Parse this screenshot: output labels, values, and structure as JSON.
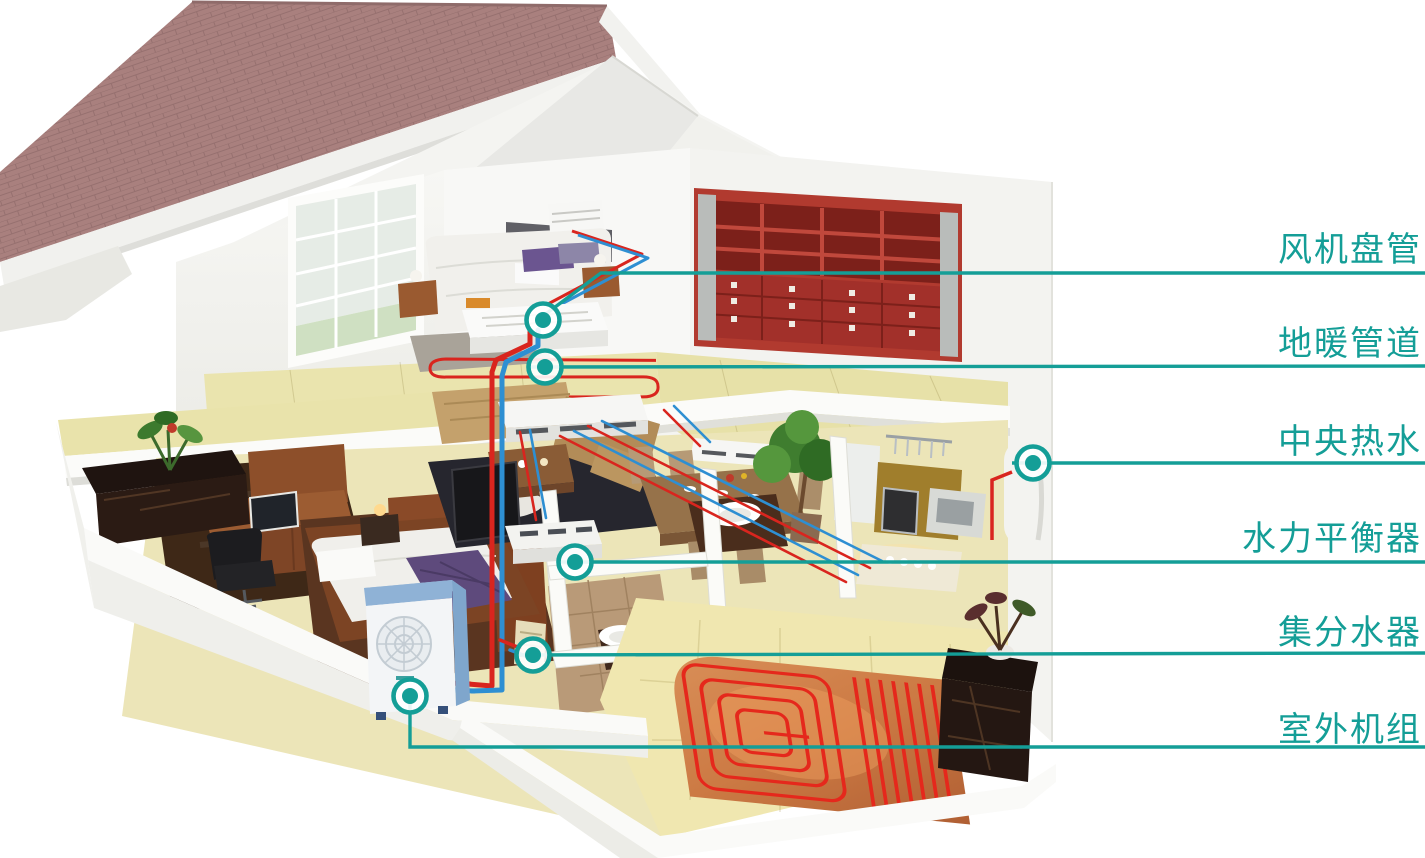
{
  "figure": {
    "type": "cutaway-house-hvac-diagram",
    "background": "#ffffff",
    "palette": {
      "accent": "#149e97",
      "pipe_red": "#d9251e",
      "pipe_blue": "#2e8fd2",
      "roof": "#a9807e",
      "roof_line": "#8f6b6a",
      "floor_yellow": "#eae4ac",
      "bookshelf_red": "#b13a2f",
      "outdoor_unit_blue": "#8fb2d6",
      "heating_pad_copper": "#c97b4b",
      "marble_dark": "#241712",
      "wood": "#8a4f2a"
    },
    "annotations": [
      {
        "id": "fan-coil",
        "text": "风机盘管",
        "label_x": 1422,
        "label_y": 261,
        "marker": [
          543,
          320
        ],
        "line": [
          [
            543,
            316
          ],
          [
            601,
            273
          ],
          [
            1425,
            273
          ]
        ]
      },
      {
        "id": "floor-heating-pipe",
        "text": "地暖管道",
        "label_x": 1422,
        "label_y": 355,
        "marker": [
          545,
          367
        ],
        "line": [
          [
            527,
            367
          ],
          [
            1425,
            366
          ]
        ]
      },
      {
        "id": "central-hot-water",
        "text": "中央热水",
        "label_x": 1422,
        "label_y": 453,
        "marker": [
          1033,
          463
        ],
        "line": [
          [
            1012,
            463
          ],
          [
            1425,
            463
          ]
        ]
      },
      {
        "id": "hydraulic-balancer",
        "text": "水力平衡器",
        "label_x": 1422,
        "label_y": 550,
        "marker": [
          575,
          562
        ],
        "line": [
          [
            558,
            562
          ],
          [
            1425,
            562
          ]
        ]
      },
      {
        "id": "manifold",
        "text": "集分水器",
        "label_x": 1422,
        "label_y": 644,
        "marker": [
          533,
          655
        ],
        "line": [
          [
            516,
            655
          ],
          [
            1425,
            653
          ]
        ]
      },
      {
        "id": "outdoor-unit",
        "text": "室外机组",
        "label_x": 1422,
        "label_y": 741,
        "marker": [
          410,
          696
        ],
        "line": [
          [
            410,
            700
          ],
          [
            410,
            747
          ],
          [
            1425,
            747
          ]
        ]
      }
    ]
  }
}
